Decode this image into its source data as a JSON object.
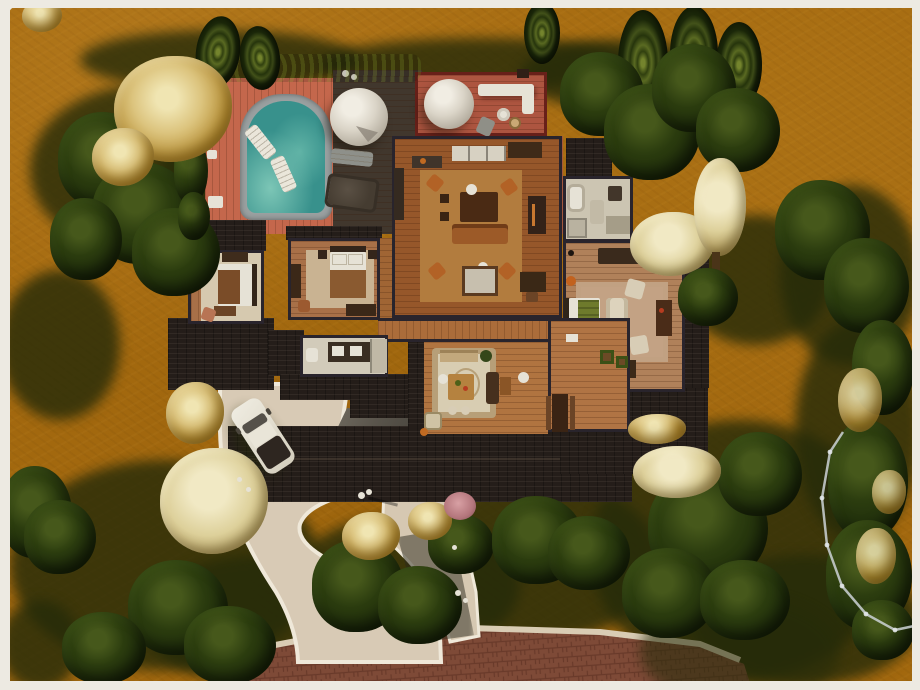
{
  "scene": {
    "description": "Top-down aerial screenshot of a suburban autumn lot in a life-simulation game: single-story house with pool deck, two geodesic dome tents, curved gravel driveway, parked SUV and brick street",
    "view": "top-down build view"
  },
  "palette": {
    "frame": "#edeae2",
    "terrain": "#a4690f",
    "shadow": "#252b09",
    "tree_dark": "#24340c",
    "tree_gold": "#d9c47c",
    "pool_water": "#3a8f8a",
    "deck_salmon": "#c4674c",
    "deck_red": "#ad5540",
    "deck_dark": "#40362c",
    "roof": "#241d19",
    "wood_floor": "#96572a",
    "pale_tile": "#ccc5b2",
    "gravel": "#d8cab5",
    "brick_road": "#7e4a37",
    "car_body": "#e7e3d6",
    "fence": "#ccd2d6"
  },
  "objects": {
    "pool": "Swimming pool with float loungers",
    "pool_deck": "Salmon plank pool deck",
    "dome_tent_a": "Geodesic dome tent",
    "dome_tent_b": "Geodesic dome tent",
    "roof_terrace": "Red plank roof terrace with white sectional",
    "car": "Parked white SUV",
    "great_room": "Open living room",
    "kitchen": "Kitchen counters",
    "dining_room": "Dining room with medallion rug",
    "master_bedroom": "Master bedroom",
    "bedroom_a": "West bedroom",
    "bedroom_b": "Middle bedroom",
    "bathroom_a": "Main bathroom",
    "bathroom_b": "Hall bathroom",
    "hallway": "Hallway",
    "mudroom": "Mudroom with farm table",
    "roof": "Shingle roof",
    "garage_pad": "Shaded garage pad",
    "driveway": "Curved gravel driveway",
    "front_walk": "Front walkway",
    "street": "Herringbone brick street",
    "fence": "Light garden fence",
    "hedge": "Hedge row",
    "trees": "Autumn trees and shrubs",
    "street_lamp": "Walkway lamp",
    "hot_tub": "Deck hot tub",
    "deck_lounger": "Deck lounger"
  }
}
